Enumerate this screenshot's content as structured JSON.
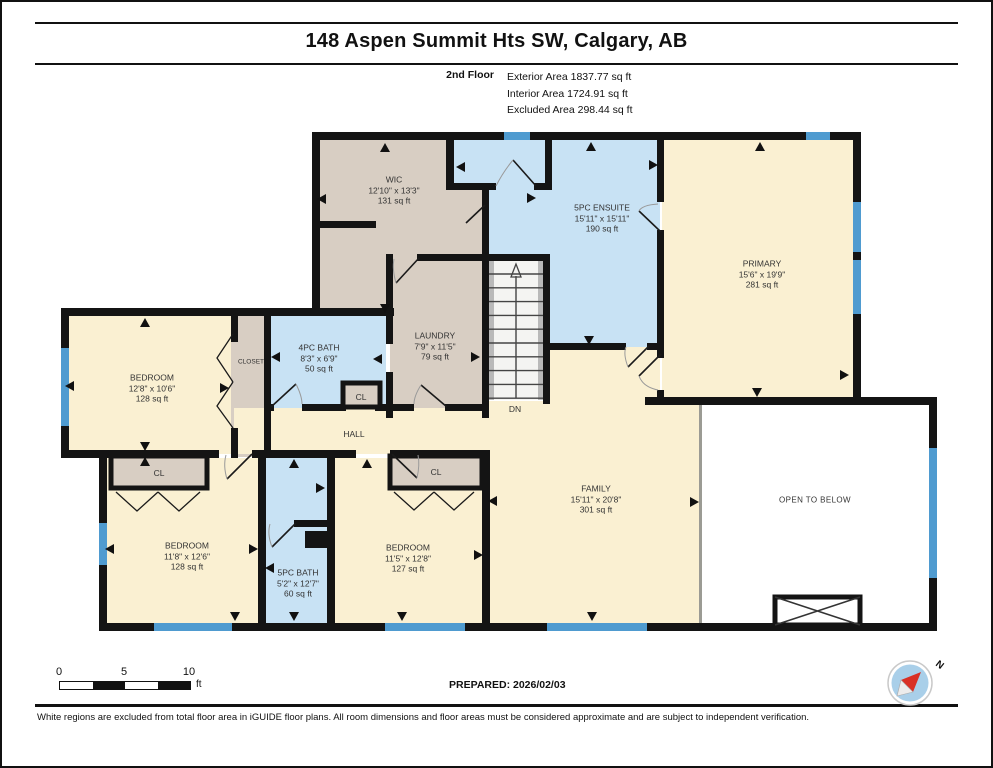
{
  "header": {
    "title": "148 Aspen Summit Hts SW, Calgary, AB",
    "floor_label": "2nd Floor",
    "stats": [
      "Exterior Area 1837.77 sq ft",
      "Interior Area 1724.91 sq ft",
      "Excluded Area 298.44 sq ft"
    ]
  },
  "rooms": [
    {
      "name": "WIC",
      "dims": "12'10\" x 13'3\"",
      "area": "131 sq ft"
    },
    {
      "name": "5PC ENSUITE",
      "dims": "15'11\" x 15'11\"",
      "area": "190 sq ft"
    },
    {
      "name": "PRIMARY",
      "dims": "15'6\" x 19'9\"",
      "area": "281 sq ft"
    },
    {
      "name": "BEDROOM",
      "dims": "12'8\" x 10'6\"",
      "area": "128 sq ft"
    },
    {
      "name": "4PC BATH",
      "dims": "8'3\" x 6'9\"",
      "area": "50 sq ft"
    },
    {
      "name": "LAUNDRY",
      "dims": "7'9\" x 11'5\"",
      "area": "79 sq ft"
    },
    {
      "name": "BEDROOM",
      "dims": "11'8\" x 12'6\"",
      "area": "128 sq ft"
    },
    {
      "name": "5PC BATH",
      "dims": "5'2\" x 12'7\"",
      "area": "60 sq ft"
    },
    {
      "name": "BEDROOM",
      "dims": "11'5\" x 12'8\"",
      "area": "127 sq ft"
    },
    {
      "name": "FAMILY",
      "dims": "15'11\" x 20'8\"",
      "area": "301 sq ft"
    }
  ],
  "labels": {
    "open_to_below": "OPEN TO BELOW",
    "closet": "CLOSET",
    "cl": "CL",
    "hall": "HALL",
    "dn": "DN"
  },
  "scale_bar": {
    "ticks": [
      "0",
      "5",
      "10"
    ],
    "unit": "ft"
  },
  "compass": {
    "north_label": "N"
  },
  "footer": {
    "prepared": "PREPARED: 2026/02/03",
    "disclaimer": "White regions are excluded from total floor area in iGUIDE floor plans. All room dimensions and floor areas must be considered approximate and are subject to independent verification."
  },
  "colors": {
    "room_cream": "#FAF0D2",
    "room_tan": "#D8CEC3",
    "room_wet_blue": "#C8E2F4",
    "window_blue": "#4F9BD0",
    "wall_black": "#141414",
    "railing_gray": "#9B9B94"
  }
}
